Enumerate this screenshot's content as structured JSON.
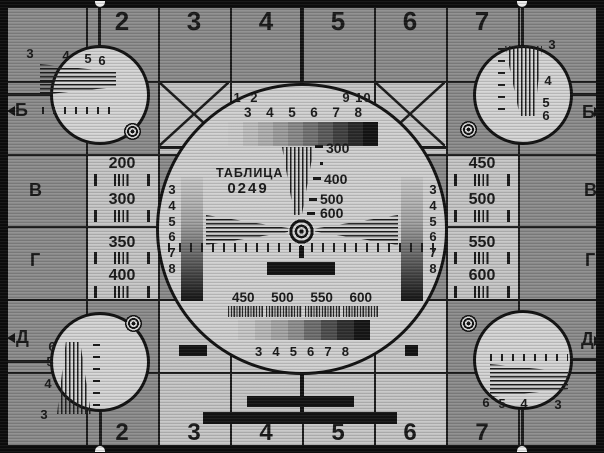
{
  "palette": {
    "frame": "#0d0d0d",
    "dark_cell": "#8d8d8d",
    "light_cell": "#c7c7c7",
    "circle_fill": "#d2d2d2",
    "line": "#1c1c1c",
    "text": "#1a1a1a",
    "white_marker": "#efefef"
  },
  "grid": {
    "top_labels": [
      "2",
      "3",
      "4",
      "5",
      "6",
      "7"
    ],
    "bottom_labels": [
      "2",
      "3",
      "4",
      "5",
      "6",
      "7"
    ],
    "left_letters": [
      "Б",
      "В",
      "Г",
      "Д"
    ],
    "right_letters": [
      "Б",
      "В",
      "Г",
      "Д"
    ]
  },
  "left_panel": {
    "values": [
      "200",
      "300",
      "350",
      "400"
    ]
  },
  "right_panel": {
    "values": [
      "450",
      "500",
      "550",
      "600"
    ]
  },
  "center_circle": {
    "title": "ТАБЛИЦА",
    "code": "0249",
    "top_left_label": "1 2",
    "top_right_label": "9 10",
    "top_gray_labels": [
      "3",
      "4",
      "5",
      "6",
      "7",
      "8"
    ],
    "wedge_labels": [
      "300",
      "400",
      "500",
      "600"
    ],
    "left_scale_numbers": [
      "3",
      "4",
      "5",
      "6",
      "7",
      "8"
    ],
    "right_scale_numbers": [
      "3",
      "4",
      "5",
      "6",
      "7",
      "8"
    ],
    "bottom_freq_labels": [
      "450",
      "500",
      "550",
      "600"
    ],
    "bottom_gray_labels": [
      "3",
      "4",
      "5",
      "6",
      "7",
      "8"
    ]
  },
  "corner_circles": {
    "top_left": {
      "labels": [
        "3",
        "4",
        "5",
        "6"
      ]
    },
    "top_right": {
      "labels": [
        "3",
        "4",
        "5",
        "6"
      ]
    },
    "bottom_left": {
      "labels": [
        "6",
        "5",
        "4",
        "3"
      ]
    },
    "bottom_right": {
      "labels": [
        "6",
        "5",
        "4",
        "3"
      ]
    }
  },
  "gray_steps_top": [
    "#cecece",
    "#c0c0c0",
    "#b1b1b1",
    "#9f9f9f",
    "#8b8b8b",
    "#747474",
    "#5d5d5d",
    "#434343",
    "#2b2b2b",
    "#151515"
  ],
  "gray_steps_bottom": [
    "#c9c9c9",
    "#bababa",
    "#a7a7a7",
    "#909090",
    "#707070",
    "#505050",
    "#313131",
    "#171717"
  ]
}
